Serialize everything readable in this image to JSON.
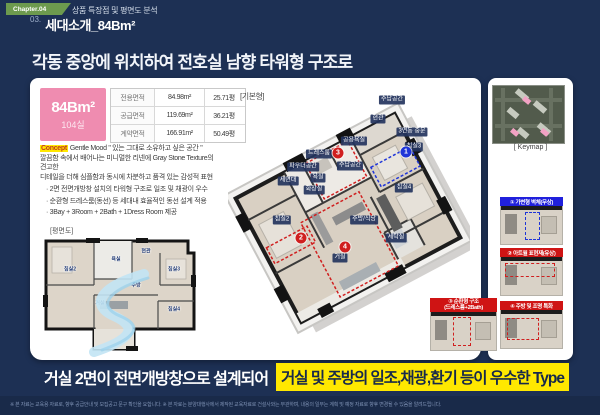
{
  "page": {
    "chapter_badge": "Chapter.04",
    "chapter_title": "상품 특장점 및 평면도 분석",
    "section_no": "03.",
    "section_title": "세대소개_84Bm²",
    "headline": "각동 중앙에 위치하여 전호실 남향 타워형 구조로",
    "footer": "※ 본 자료는 교육용 자료로, 향후 공급안내 및 모집공고 문구 확인을 요합니다.   ※ 본 자료는 분양대행사에서 제작된 교육자료로 건설사와는 무관하며, 내용의 일부는 계획 및 예정 자료로 향후 변경될 수 있음을 알려드립니다."
  },
  "unit": {
    "name": "84Bm²",
    "count": "104실",
    "plan_type": "[기본형]",
    "areas": [
      {
        "label": "전용면적",
        "sqm": "84.98m²",
        "pyeong": "25.71평"
      },
      {
        "label": "공급면적",
        "sqm": "119.69m²",
        "pyeong": "36.21평"
      },
      {
        "label": "계약면적",
        "sqm": "166.91m²",
        "pyeong": "50.49평"
      }
    ]
  },
  "concept": {
    "tag": "Concept",
    "head": "Gentle Mood \" 있는 그대로 소유하고 싶은 공간 \"",
    "rest": [
      {
        "text": "깔끔함 속에서 배어나는 미니멀한 리넨에 Gray Stone Texture의"
      },
      {
        "text": "견고한"
      },
      {
        "text": "디테일을 더해 심플함과 동시에 차분하고 품격 있는 감성적 표현"
      }
    ],
    "bullets": [
      {
        "text": "· 2면 전면개방창 설치의 타워형 구조로 일조 및 채광이 우수"
      },
      {
        "text": "· 순환형 드레스룸(동선) 등 세대내 효율적인 동선 설계 적용"
      },
      {
        "text": "· 3Bay + 3Room + 2Bath + 1Dress Room 제공"
      }
    ]
  },
  "plan2d": {
    "caption": "[평면도]",
    "labels": [
      {
        "text": "침실2",
        "x": 34,
        "y": 34
      },
      {
        "text": "욕실",
        "x": 80,
        "y": 24
      },
      {
        "text": "현관",
        "x": 110,
        "y": 16
      },
      {
        "text": "침실3",
        "x": 138,
        "y": 34
      },
      {
        "text": "주방",
        "x": 100,
        "y": 50
      },
      {
        "text": "거실",
        "x": 64,
        "y": 68
      },
      {
        "text": "침실4",
        "x": 138,
        "y": 74
      }
    ]
  },
  "plan3d": {
    "labels": [
      {
        "text": "수납공간",
        "x": 164,
        "y": 14
      },
      {
        "text": "현관",
        "x": 150,
        "y": 33
      },
      {
        "text": "3연동 중문",
        "x": 184,
        "y": 46
      },
      {
        "text": "공용욕실",
        "x": 126,
        "y": 55
      },
      {
        "text": "침실3",
        "x": 186,
        "y": 61
      },
      {
        "text": "드레스룸",
        "x": 91,
        "y": 68
      },
      {
        "text": "수납공간",
        "x": 122,
        "y": 80
      },
      {
        "text": "파우더공간",
        "x": 75,
        "y": 81
      },
      {
        "text": "욕실",
        "x": 90,
        "y": 92
      },
      {
        "text": "세면대",
        "x": 60,
        "y": 95
      },
      {
        "text": "화장실",
        "x": 86,
        "y": 104
      },
      {
        "text": "침실4",
        "x": 176,
        "y": 102
      },
      {
        "text": "침실2",
        "x": 54,
        "y": 134
      },
      {
        "text": "주방/식당",
        "x": 136,
        "y": 134
      },
      {
        "text": "세탁실",
        "x": 168,
        "y": 152
      },
      {
        "text": "거실",
        "x": 112,
        "y": 172
      }
    ],
    "badges": [
      {
        "n": "1",
        "x": 178,
        "y": 66,
        "color": "#1f35d8"
      },
      {
        "n": "2",
        "x": 73,
        "y": 152,
        "color": "#d01f1f"
      },
      {
        "n": "3",
        "x": 110,
        "y": 67,
        "color": "#d01f1f"
      },
      {
        "n": "4",
        "x": 117,
        "y": 161,
        "color": "#d01f1f"
      }
    ]
  },
  "keymap": {
    "caption": "[ Keymap ]"
  },
  "callouts": [
    {
      "title": "① 가변형 벽체(무상)"
    },
    {
      "title": "② 아트월 표현재(유상)"
    },
    {
      "title": "③ 순환형 구조",
      "title2": "(드레스룸+2Bath)"
    },
    {
      "title": "④ 주방 및 조명 특화"
    }
  ],
  "bottom": {
    "plain": "거실 2면이 전면개방창으로 설계되어",
    "highlight": "거실 및 주방의 일조,채광,환기 등이 우수한 Type"
  },
  "colors": {
    "accent_red": "#d01f1f",
    "accent_blue": "#1f35d8",
    "pink": "#ef8cb0",
    "yellow": "#ffe800",
    "navy": "#1d3054",
    "green": "#6d9a4e"
  }
}
